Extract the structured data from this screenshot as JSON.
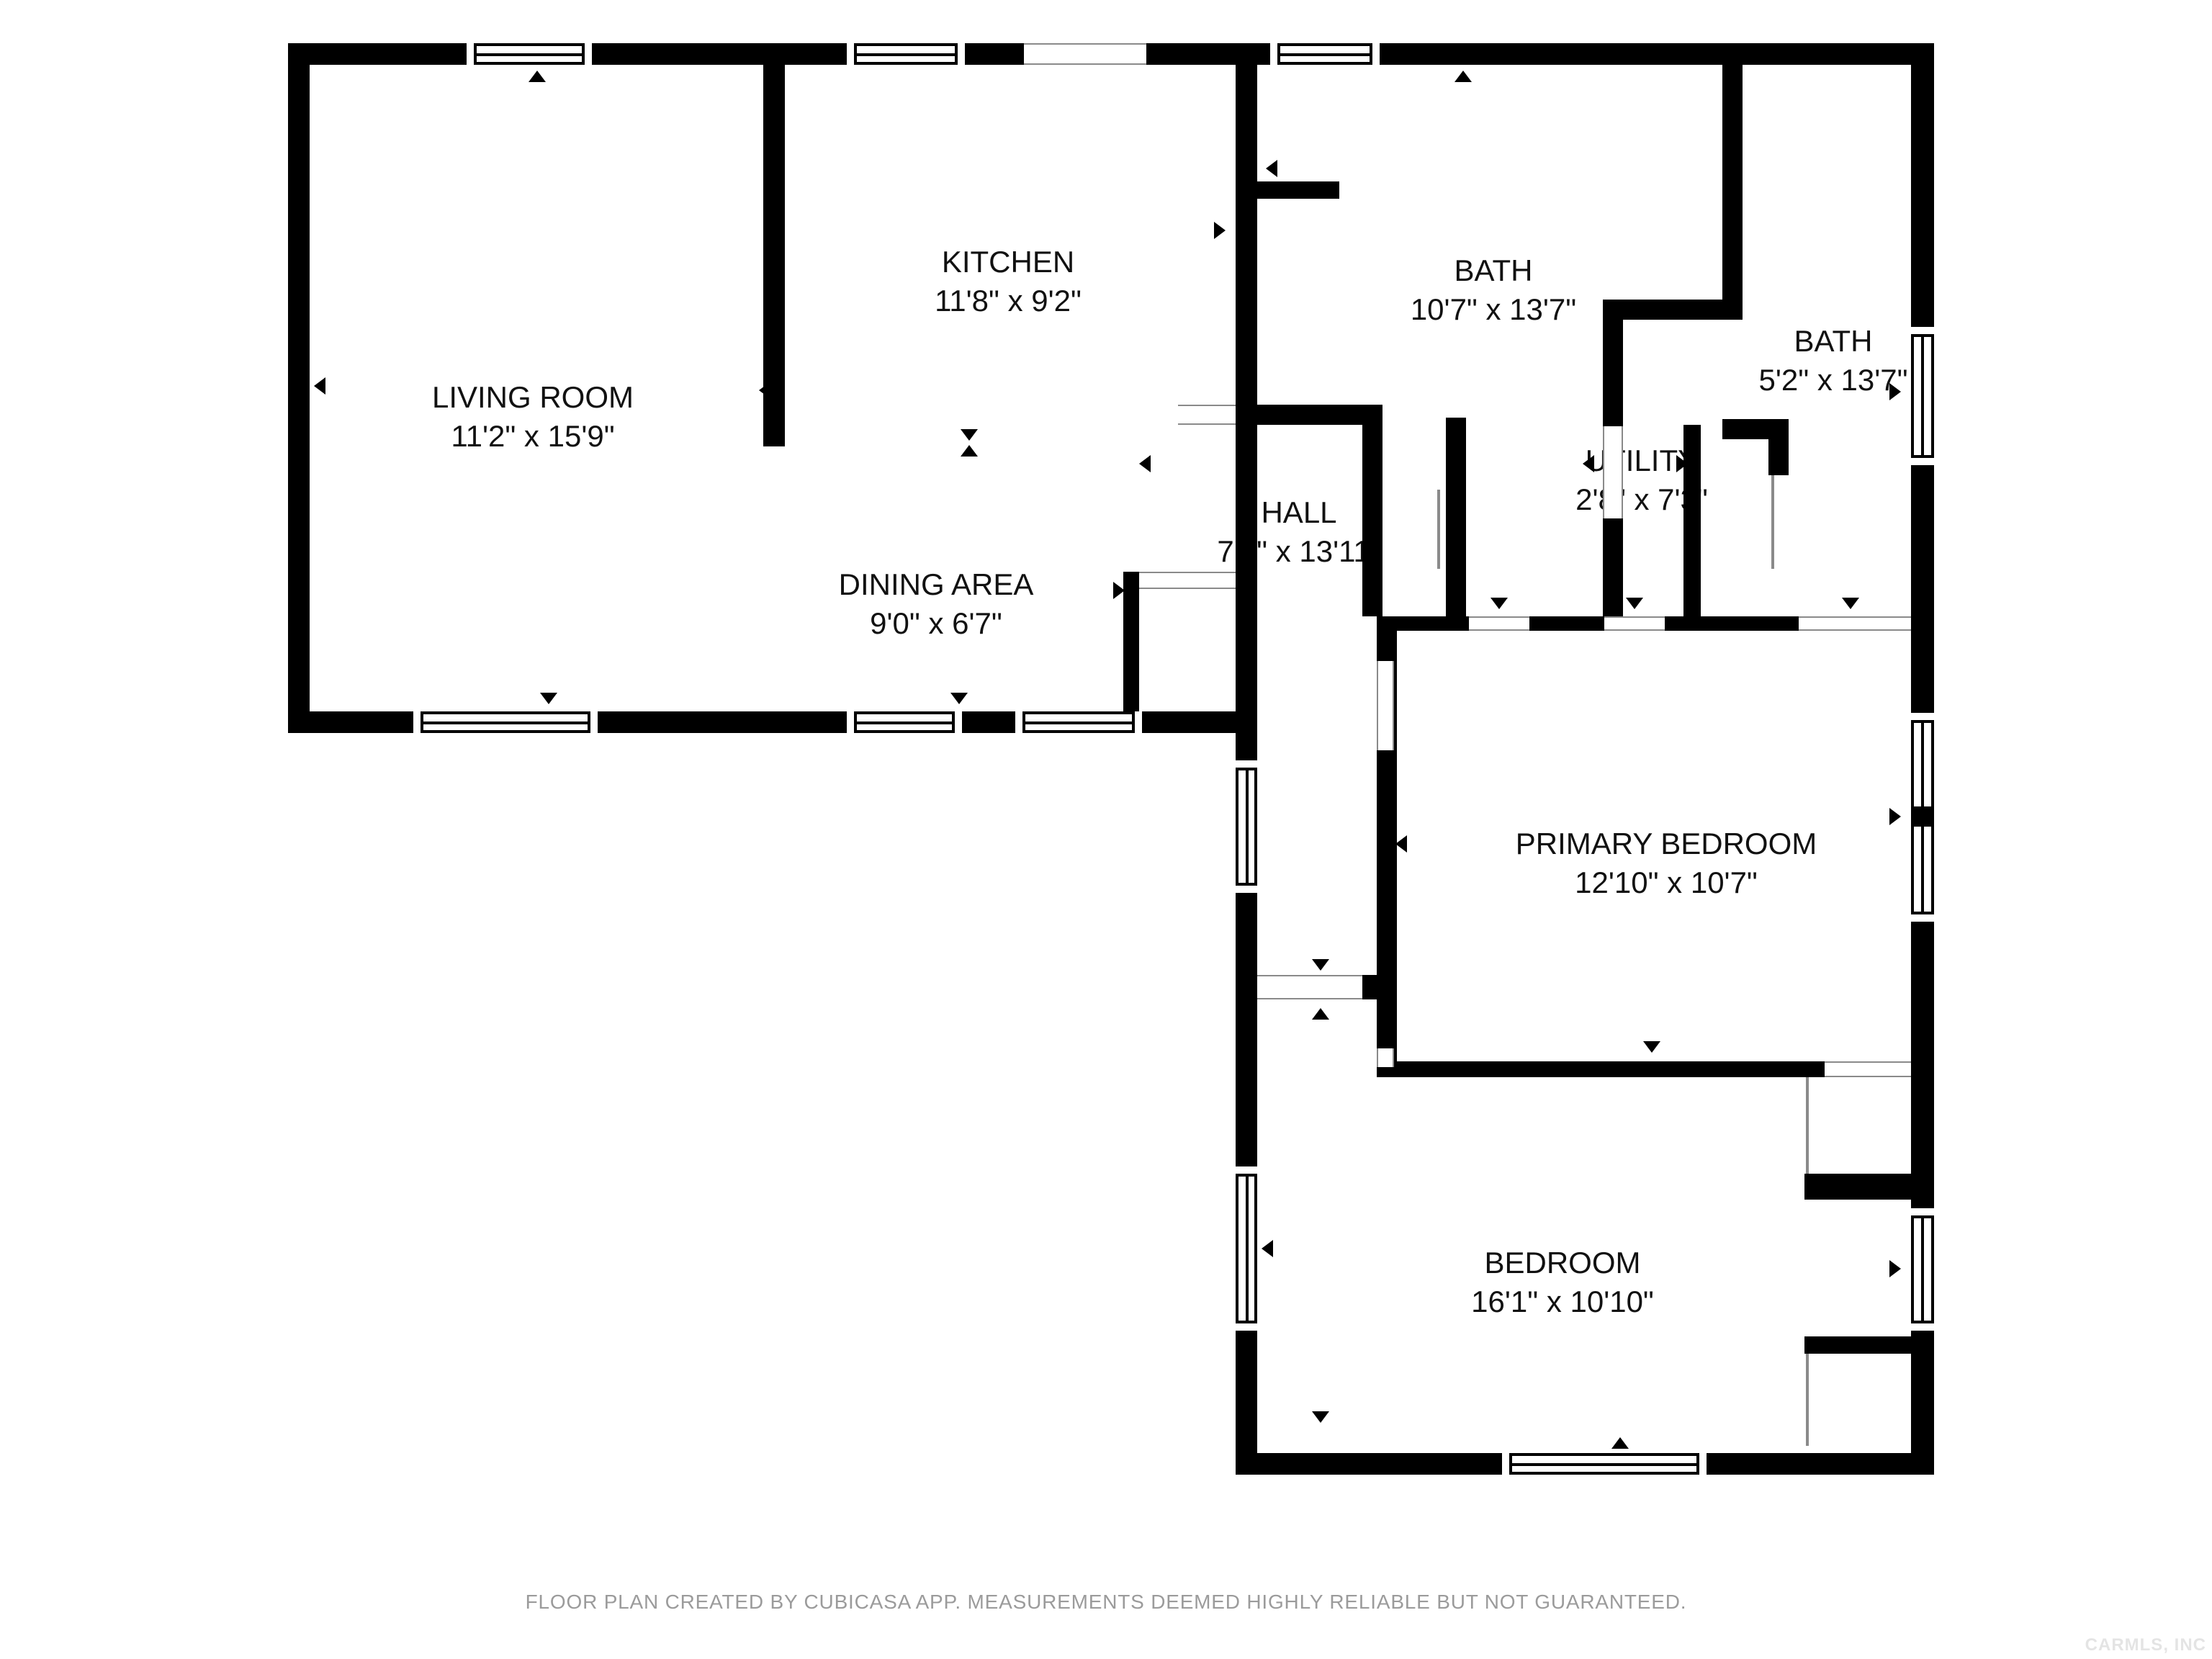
{
  "rooms": [
    {
      "key": "living",
      "name": "LIVING ROOM",
      "dims": "11'2\" x 15'9\""
    },
    {
      "key": "kitchen",
      "name": "KITCHEN",
      "dims": "11'8\" x 9'2\""
    },
    {
      "key": "dining",
      "name": "DINING AREA",
      "dims": "9'0\" x 6'7\""
    },
    {
      "key": "hall",
      "name": "HALL",
      "dims": "7'6\" x 13'11\""
    },
    {
      "key": "bath1",
      "name": "BATH",
      "dims": "10'7\" x 13'7\""
    },
    {
      "key": "bath2",
      "name": "BATH",
      "dims": "5'2\" x 13'7\""
    },
    {
      "key": "utility",
      "name": "UTILITY",
      "dims": "2'8\" x 7'3\""
    },
    {
      "key": "primary",
      "name": "PRIMARY BEDROOM",
      "dims": "12'10\" x 10'7\""
    },
    {
      "key": "bedroom",
      "name": "BEDROOM",
      "dims": "16'1\" x 10'10\""
    }
  ],
  "footer": {
    "text": "FLOOR PLAN CREATED BY CUBICASA APP. MEASUREMENTS DEEMED HIGHLY RELIABLE BUT NOT GUARANTEED."
  },
  "watermark": {
    "text": "CARMLS, INC"
  },
  "colors": {
    "wall": "#000000",
    "background": "#ffffff",
    "label_text": "#111111",
    "thin_line": "#8a8a8a",
    "footer_text": "#9b9b9b",
    "watermark_text": "#e4e4e4"
  }
}
